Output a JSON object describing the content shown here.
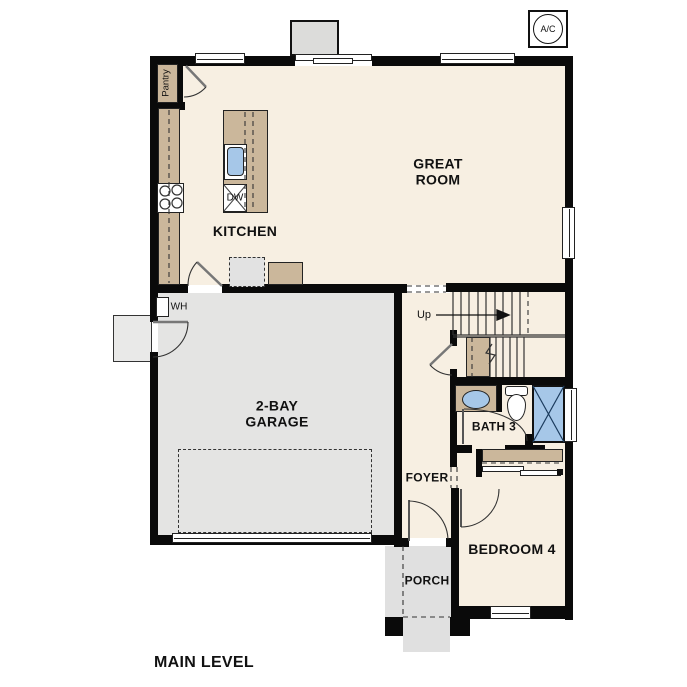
{
  "title": "MAIN LEVEL",
  "rooms": {
    "great_room": "GREAT\nROOM",
    "kitchen": "KITCHEN",
    "garage": "2-BAY\nGARAGE",
    "foyer": "FOYER",
    "bath": "BATH 3",
    "bedroom": "BEDROOM 4",
    "porch": "PORCH",
    "pantry": "Pantry"
  },
  "annotations": {
    "ac_unit": "A/C",
    "water_heater": "WH",
    "stairs_direction": "Up",
    "dishwasher": "DW"
  },
  "colors": {
    "room_fill": "#f7efe2",
    "cabinet_tan": "#cbb79b",
    "garage_gray": "#e4e4e3",
    "porch_gray": "#e0e0e0",
    "stoop_gray": "#e9e9e8",
    "fireplace_gray": "#dcdcda",
    "fixture_blue": "#a6c7e8",
    "wall": "#0a0a0a"
  }
}
